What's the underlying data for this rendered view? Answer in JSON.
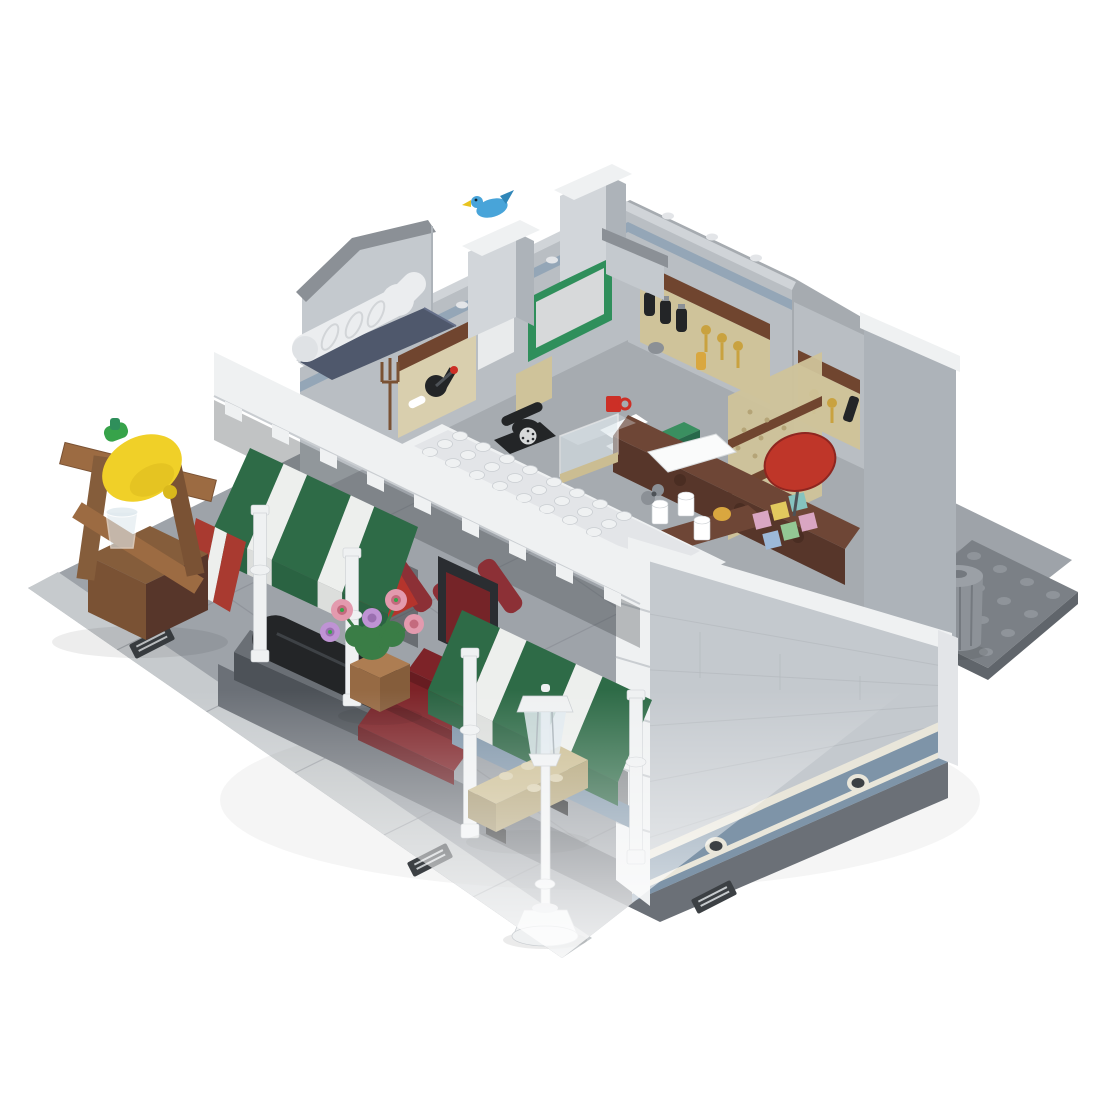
{
  "canvas": {
    "width": 1100,
    "height": 1100,
    "background": "#ffffff"
  },
  "image": {
    "kind": "3d-render-product-photo",
    "subject": "LEGO-style modular corner shop model with open roofless interior, striped awnings, street lamp and lemonade-press stand on a tiled plaza"
  },
  "scene": {
    "objects": [
      {
        "id": "plaza",
        "label": "light gray tiled plaza baseplate"
      },
      {
        "id": "sidewalk",
        "label": "dark gray sidewalk strip along building"
      },
      {
        "id": "drain-grates",
        "label": "three metal drain grates"
      },
      {
        "id": "rear-baseplate",
        "label": "dark gray studded plate corner"
      },
      {
        "id": "trash-can",
        "label": "gray trash can"
      },
      {
        "id": "building",
        "label": "white and light-gray modular shop, roof removed"
      },
      {
        "id": "right-wall",
        "label": "light bluish gray brick wall with sand-blue base band and technic pin holes"
      },
      {
        "id": "cornice",
        "label": "white dentil cornice over shopfront"
      },
      {
        "id": "awnings",
        "label": "green and white striped awnings, red corner panel"
      },
      {
        "id": "entrance-steps",
        "label": "dark red entrance steps"
      },
      {
        "id": "columns",
        "label": "four white lathe columns"
      },
      {
        "id": "bay-roof-tray",
        "label": "white studded bay-window roof tray"
      },
      {
        "id": "chimney-with-bird",
        "label": "gray chimney with blue bird"
      },
      {
        "id": "vent-pipe",
        "label": "white curved vent pipe"
      },
      {
        "id": "interior",
        "label": "apothecary interior: shelves, bottles, rotary phone, display case, counter, pastel bricks, red disc sign"
      },
      {
        "id": "chalkboard",
        "label": "green framed board on back wall"
      },
      {
        "id": "street-lamp",
        "label": "white street lamp"
      },
      {
        "id": "bench",
        "label": "tan bench"
      },
      {
        "id": "flower-pot",
        "label": "pot with pink and lavender flowers"
      },
      {
        "id": "lemonade-stand",
        "label": "wooden press stand with giant lemon and glass"
      }
    ]
  },
  "colors": {
    "plaza": "#9ea3a9",
    "curb": "#c6cacd",
    "plaza_seam": "#85898f",
    "sidewalk": "#6b7077",
    "plate": "#7b8086",
    "plate_edge": "#60656b",
    "stud_plate": "#8f949a",
    "trash": "#8d9298",
    "trash_lid": "#9ba0a6",
    "trash_dark": "#74797f",
    "wall_gray": "#c4c9ce",
    "wall_gray_dark": "#adb3b9",
    "chimney": "#d2d6da",
    "brick_line": "#b3b8bd",
    "band_white": "#eff1f2",
    "wall_white_dim": "#e3e5e8",
    "dentil_shade": "#c9cdd1",
    "under_shadow": "#3e4347",
    "sand_blue": "#7e94a8",
    "sand_blue_trim": "#e9e6da",
    "hole_dark": "#3c4044",
    "slate": "#4f586c",
    "slate_light": "#66708a",
    "interior_base": "#a6abb0",
    "inner_wall": "#b9bec3",
    "inner_wall_top": "#d0d4d8",
    "inner_stripe": "#8da2b5",
    "chalk_green": "#2f8f5b",
    "chalk_face": "#d7d9da",
    "panel_white": "#e9ebec",
    "panel_tan": "#cfc39a",
    "tan_dot": "#b5a477",
    "shelf_brown": "#70452f",
    "brown": "#6e4636",
    "brown_dark": "#57362a",
    "knob": "#4a2d22",
    "beige": "#d9cfae",
    "tan": "#cbbd92",
    "tan_dark": "#b3a478",
    "tan_side": "#a3946c",
    "nougat": "#ad7d52",
    "nougat_dark": "#966a44",
    "nougat_side": "#855d3b",
    "wood": "#9c6b42",
    "wood_dark": "#7a5234",
    "awning_green": "#2e6b47",
    "awning_white": "#edefed",
    "awning_red": "#a93a30",
    "dark_red": "#7d2328",
    "dark_red_face": "#671c21",
    "blade_red": "#8c3036",
    "red": "#b5342c",
    "machine_gray": "#6a6f75",
    "machine_gray_dark": "#4d5258",
    "black": "#232527",
    "gray_mid": "#8b9096",
    "gray_dark": "#4d5257",
    "gold": "#c9a23f",
    "amber": "#d9a73f",
    "green_box": "#2f7d52",
    "green_box_top": "#3a8f60",
    "green_box_side": "#27694a",
    "mug_red": "#cc2f26",
    "lemon": "#f0d028",
    "lemon_shade": "#d9b81c",
    "leaf": "#37a34a",
    "bird_blue": "#48a4d9",
    "bird_wing": "#2f86b8",
    "beak": "#e8c31f",
    "glass": "#dfe9ee",
    "pane": "#a9b3b9",
    "pink": "#e39aae",
    "pink_dark": "#c46a7e",
    "lavender": "#bf93d4",
    "lavender_dark": "#9a6fb0",
    "bush": "#3a7d46",
    "floor_green": "#4f7a5f",
    "pastel_pink": "#d9a6c2",
    "pastel_yellow": "#e2c95e",
    "pastel_teal": "#86c3bf",
    "pastel_green": "#93c794",
    "pastel_blue": "#9db9d9",
    "disc_red": "#bf3629",
    "disc_rim": "#8e2620",
    "paper": "#fafbfb",
    "white": "#ffffff",
    "door_dark": "#2a2d31",
    "pipe_white": "#ebedef",
    "pipe_ring": "#d2d5d8",
    "pipe_cap": "#dfe2e5"
  }
}
